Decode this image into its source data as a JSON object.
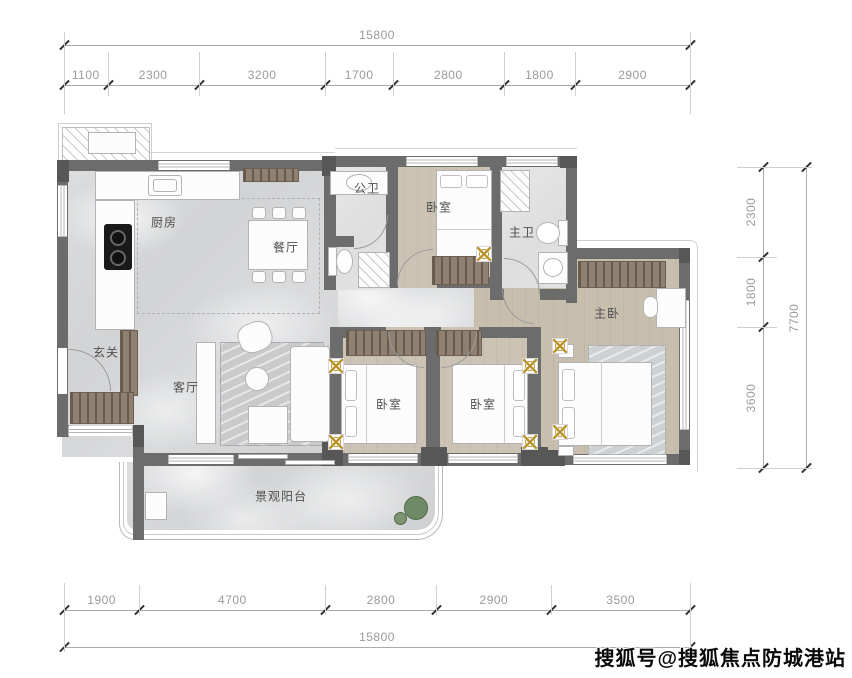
{
  "watermark": {
    "text": "搜狐号@搜狐焦点防城港站"
  },
  "dimensions": {
    "top": {
      "total": "15800",
      "segments": [
        "1100",
        "2300",
        "3200",
        "1700",
        "2800",
        "1800",
        "2900"
      ]
    },
    "bottom": {
      "total": "15800",
      "segments": [
        "1900",
        "4700",
        "2800",
        "2900",
        "3500"
      ]
    },
    "right": {
      "total": "7700",
      "segments": [
        "2300",
        "1800",
        "3600"
      ]
    }
  },
  "rooms": [
    {
      "name": "kitchen",
      "label": "厨房",
      "x": 164,
      "y": 222
    },
    {
      "name": "dining-room",
      "label": "餐厅",
      "x": 286,
      "y": 247
    },
    {
      "name": "guest-bathroom",
      "label": "公卫",
      "x": 367,
      "y": 188
    },
    {
      "name": "bedroom-north",
      "label": "卧室",
      "x": 439,
      "y": 207
    },
    {
      "name": "master-bathroom",
      "label": "主卫",
      "x": 522,
      "y": 232
    },
    {
      "name": "master-bedroom",
      "label": "主卧",
      "x": 607,
      "y": 313
    },
    {
      "name": "foyer",
      "label": "玄关",
      "x": 106,
      "y": 352
    },
    {
      "name": "living-room",
      "label": "客厅",
      "x": 186,
      "y": 387
    },
    {
      "name": "bedroom-south-left",
      "label": "卧室",
      "x": 389,
      "y": 404
    },
    {
      "name": "bedroom-south-right",
      "label": "卧室",
      "x": 483,
      "y": 404
    },
    {
      "name": "balcony",
      "label": "景观阳台",
      "x": 281,
      "y": 496
    }
  ],
  "colors": {
    "wall": "#6c6c6c",
    "wood_floor": "#c8bfb1",
    "marble_floor": "#d8d9da",
    "wardrobe": "#8f8172",
    "light_accent": "#bb9733",
    "plant": "#6f8a67",
    "dimension_text": "#9a9a9a",
    "room_label": "#4f4f4f"
  }
}
